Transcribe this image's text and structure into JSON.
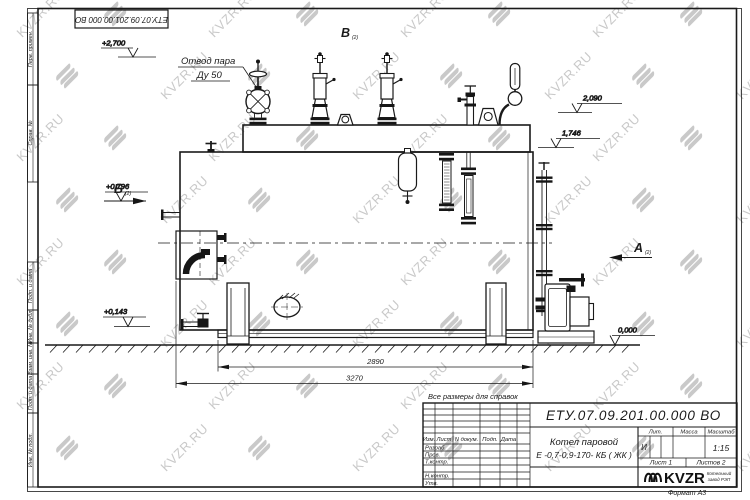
{
  "sheet": {
    "stamp_top": "ЕТУ.07.09.201.00.000  ВО",
    "format_note": "Формат А3",
    "ref_note": "Все размеры для справок"
  },
  "watermark": {
    "text": "KVZR.RU"
  },
  "margin_labels": {
    "perv": "Перв. примен.",
    "sprav": "Справ. №",
    "podp1": "Подп. и дата",
    "inv_dubl": "Инв. № дубл.",
    "vzam": "Взам. инв. №",
    "podp2": "Подп. и дата",
    "inv_podl": "Инв. № подл."
  },
  "drawing": {
    "callout": {
      "line1": "Отвод пара",
      "line2": "Ду 50"
    },
    "views": {
      "a": "А",
      "b": "Б",
      "v": "В",
      "sub": "(2)"
    },
    "levels": {
      "l2700": "+2,700",
      "l2090": "2,090",
      "l1746": "1,746",
      "l0796": "+0,796",
      "l0143": "+0,143",
      "l0000": "0,000"
    },
    "dims": {
      "d2890": "2890",
      "d3270": "3270"
    }
  },
  "titleblock": {
    "designation": "ЕТУ.07.09.201.00.000  ВО",
    "name_line1": "Котел паровой",
    "name_line2": "Е -0,7-0,9-170- КБ ( ЖК )",
    "header_cols": [
      "Изм.",
      "Лист",
      "N докум.",
      "Подп.",
      "Дата"
    ],
    "row_labels": [
      "Разраб.",
      "Пров.",
      "Т.контр.",
      "Н.контр.",
      "Утв."
    ],
    "lit_label": "Лит.",
    "mass_label": "Масса",
    "scale_label": "Масштаб",
    "lit_value": "И",
    "scale_value": "1:15",
    "sheet_info": "Лист 1",
    "sheets_info": "Листов 2",
    "logo_text": "KVZR",
    "logo_sub1": "Котельный",
    "logo_sub2": "завод РЭП"
  }
}
